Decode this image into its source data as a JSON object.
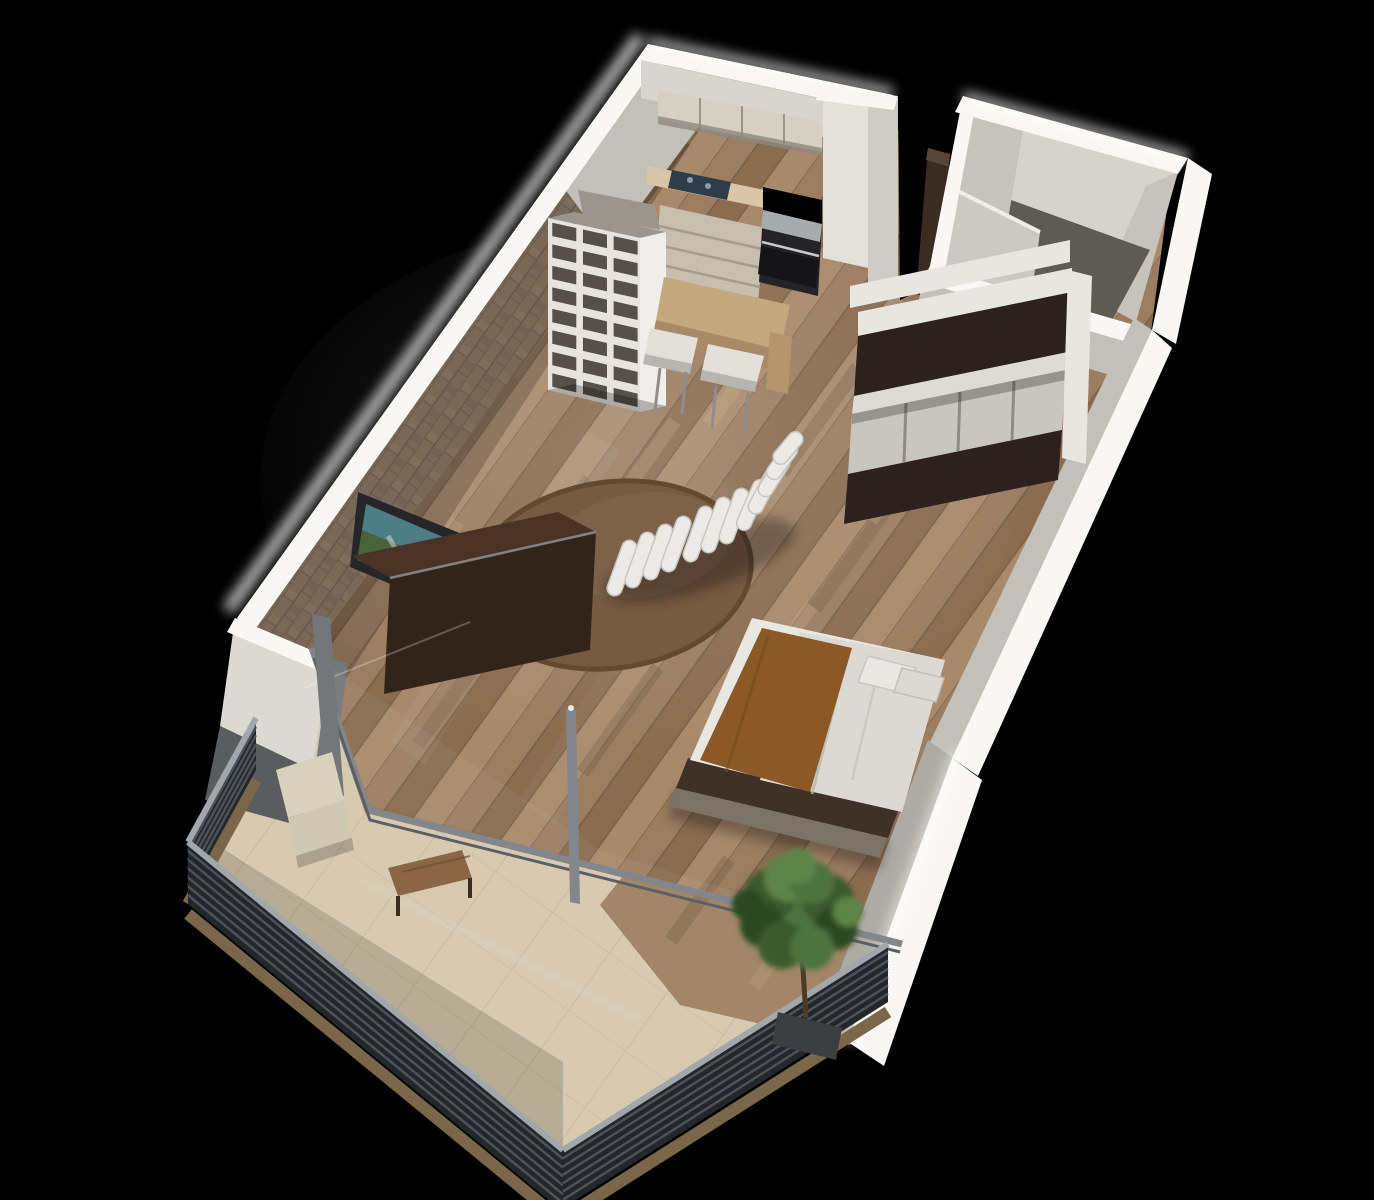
{
  "palette": {
    "bg": "#000000",
    "wall_top": "#f8f7f3",
    "wall_glow": "#ffffff",
    "wall_face_light": "#d8d5ce",
    "wall_face_mid": "#c3c0b9",
    "wall_face_dark": "#aeaba4",
    "wall_end": "#dcd9d2",
    "brick": "#8a7765",
    "brick_dark": "#6e5d4d",
    "brick_light": "#9c8974",
    "wood_a": "#9b7d61",
    "wood_b": "#8a6c50",
    "wood_c": "#a8896b",
    "wood_dark": "#6e563f",
    "wood_light": "#c9ad8c",
    "wood_seam": "#5f4a36",
    "rug": "#765a41",
    "rug_edge": "#63492f",
    "tile": "#d7cab1",
    "tile_seam": "#b4a78c",
    "tile_wood": "#9c7e5f",
    "rail_dark": "#24272a",
    "rail_slat": "#555a5e",
    "rail_cap": "#a2a7ab",
    "rail_base": "#7a6648",
    "glass_frame": "#83878b",
    "glass_frame_dark": "#5b5f63",
    "jamb": "#74777a",
    "side_wall_gray": "#5a5d60",
    "cab_upper": "#d6d0c2",
    "cab_shadow": "#8d887e",
    "counter": "#d9c6a8",
    "cooktop": "#2f3c49",
    "cab_base": "#c7bfae",
    "stove_dark": "#242426",
    "steel": "#a7abae",
    "oven": "#151517",
    "tall_cab": "#e3e1da",
    "col_face": "#cfccc5",
    "shelf_top": "#9b968d",
    "shelf_side": "#f0eeea",
    "cubby": "#55504a",
    "bar_top": "#c6a87f",
    "bar_face": "#a88a66",
    "bar_leg": "#b5946e",
    "stool": "#e2e0da",
    "stool_shade": "#b8b5ae",
    "stool_leg": "#8e8e8e",
    "tv_frame": "#26262a",
    "tv_teal": "#4e7e85",
    "tv_green": "#49623c",
    "board_top": "#4a3324",
    "board_face": "#33241a",
    "board_edge": "#8e9194",
    "ward_dark": "#2c211f",
    "ward_white": "#e8e6e0",
    "ward_shelf": "#dddbd5",
    "ward_inner": "#c9c6bf",
    "bed_white": "#e9e7e2",
    "bed_duvet": "#dcd9d3",
    "blanket": "#8a5926",
    "blanket_dark": "#774a1f",
    "platform": "#3f3127",
    "platform_step": "#7b7466",
    "bath_inner_bright": "#d6d3cc",
    "bath_inner_mid": "#c6c3bc",
    "bath_floor": "#5e5b55",
    "door": "#ccc9c2",
    "fridge": "#3a2c22",
    "fridge_top": "#5a4636",
    "chair_cream": "#d8d1bc",
    "chair_seat": "#cfc8b2",
    "bench": "#8a6647",
    "tree_g1": "#3a5a2e",
    "tree_g2": "#4e7340",
    "tree_g3": "#2c4823",
    "tree_g4": "#5d8449",
    "trunk": "#4a3a28",
    "planter": "#3c3e40",
    "chaise": "#eceae6",
    "chaise_shade": "#c9c6c0",
    "shadow": "rgba(0,0,0,0.30)",
    "streak": "rgba(255,255,255,0.05)"
  }
}
